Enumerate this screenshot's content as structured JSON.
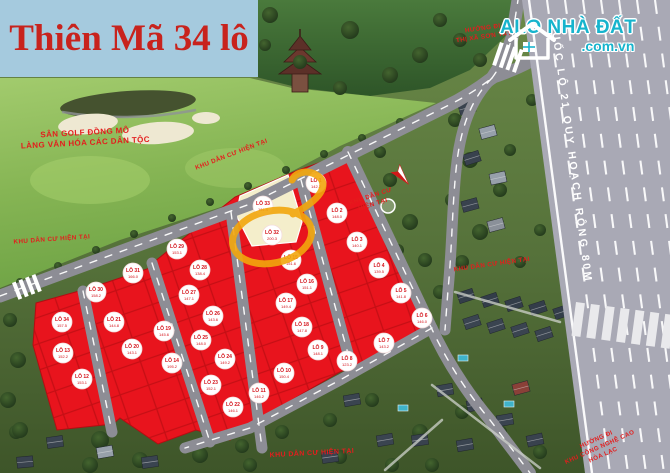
{
  "title": "Thiên Mã 34 lô",
  "logo": {
    "name": "ALO NHÀ ĐẤT",
    "domain": ".com.vn"
  },
  "colors": {
    "title_bg": "#a5cade",
    "title_text": "#c8231d",
    "plot_red": "#e8141d",
    "plot_line": "#b90d12",
    "plot_reserved_cream": "#f4eecb",
    "badge_text": "#d4121a",
    "road_gray": "#8d8d95",
    "highway_gray": "#a9a9b5",
    "highlight_orange": "#f2a70d",
    "label_red": "#e41d1d",
    "logo_teal": "#17b4cd",
    "golf_green": "#86b554"
  },
  "map": {
    "highway_label": "QUỐC LỘ 21 QUY HOẠCH RỘNG 80M",
    "labels": [
      {
        "name": "golf-label",
        "lines": [
          "SÂN GOLF ĐỒNG MÔ",
          "LÀNG VĂN HÓA CÁC DÂN TỘC"
        ],
        "x": 85,
        "y": 135,
        "rot": -3,
        "size": 8
      },
      {
        "name": "existing-residential-left",
        "lines": [
          "KHU DÂN CƯ HIỆN TẠI"
        ],
        "x": 52,
        "y": 241,
        "rot": -4,
        "size": 6.3
      },
      {
        "name": "existing-residential-top",
        "lines": [
          "KHU DÂN CƯ HIỆN TẠI"
        ],
        "x": 232,
        "y": 156,
        "rot": -21,
        "size": 6.3
      },
      {
        "name": "existing-residential-mid",
        "lines": [
          "KHU DÂN CƯ",
          "HIỆN TẠI"
        ],
        "x": 371,
        "y": 198,
        "rot": -18,
        "size": 6.3
      },
      {
        "name": "existing-residential-right",
        "lines": [
          "KHU DÂN CƯ HIỆN TẠI"
        ],
        "x": 492,
        "y": 266,
        "rot": -8,
        "size": 6.3
      },
      {
        "name": "existing-residential-bottom",
        "lines": [
          "KHU DÂN CƯ HIỆN TẠI"
        ],
        "x": 312,
        "y": 455,
        "rot": -3,
        "size": 7
      },
      {
        "name": "direction-son-tay",
        "lines": [
          "HƯỚNG ĐI",
          "THỊ XÃ SƠN TÂY"
        ],
        "x": 483,
        "y": 30,
        "rot": -8,
        "size": 6.3
      },
      {
        "name": "direction-hoa-lac",
        "lines": [
          "HƯỚNG ĐI",
          "KHU CÔNG NGHỆ CAO",
          "HÒA LẠC"
        ],
        "x": 597,
        "y": 441,
        "rot": -24,
        "size": 6.2
      }
    ]
  },
  "plots": [
    {
      "label": "LÔ 1",
      "area": "142.2",
      "x": 316,
      "y": 183
    },
    {
      "label": "LÔ 2",
      "area": "148.0",
      "x": 337,
      "y": 213
    },
    {
      "label": "LÔ 3",
      "area": "140.1",
      "x": 357,
      "y": 242
    },
    {
      "label": "LÔ 4",
      "area": "139.5",
      "x": 379,
      "y": 268
    },
    {
      "label": "LÔ 5",
      "area": "141.8",
      "x": 401,
      "y": 293
    },
    {
      "label": "LÔ 6",
      "area": "146.0",
      "x": 422,
      "y": 318
    },
    {
      "label": "LÔ 7",
      "area": "143.2",
      "x": 384,
      "y": 343
    },
    {
      "label": "LÔ 8",
      "area": "123.2",
      "x": 347,
      "y": 361
    },
    {
      "label": "LÔ 9",
      "area": "148.1",
      "x": 318,
      "y": 350
    },
    {
      "label": "LÔ 10",
      "area": "150.4",
      "x": 284,
      "y": 373
    },
    {
      "label": "LÔ 11",
      "area": "146.2",
      "x": 259,
      "y": 393
    },
    {
      "label": "LÔ 12",
      "area": "153.1",
      "x": 82,
      "y": 379
    },
    {
      "label": "LÔ 13",
      "area": "152.2",
      "x": 63,
      "y": 353
    },
    {
      "label": "LÔ 14",
      "area": "195.2",
      "x": 172,
      "y": 363
    },
    {
      "label": "LÔ 15",
      "area": "151.6",
      "x": 291,
      "y": 260
    },
    {
      "label": "LÔ 16",
      "area": "151.1",
      "x": 307,
      "y": 284
    },
    {
      "label": "LÔ 17",
      "area": "149.4",
      "x": 286,
      "y": 303
    },
    {
      "label": "LÔ 18",
      "area": "147.8",
      "x": 302,
      "y": 327
    },
    {
      "label": "LÔ 19",
      "area": "145.6",
      "x": 164,
      "y": 331
    },
    {
      "label": "LÔ 20",
      "area": "143.1",
      "x": 132,
      "y": 349
    },
    {
      "label": "LÔ 21",
      "area": "144.8",
      "x": 114,
      "y": 322
    },
    {
      "label": "LÔ 22",
      "area": "146.1",
      "x": 233,
      "y": 407
    },
    {
      "label": "LÔ 23",
      "area": "152.1",
      "x": 211,
      "y": 385
    },
    {
      "label": "LÔ 24",
      "area": "149.2",
      "x": 225,
      "y": 359
    },
    {
      "label": "LÔ 25",
      "area": "148.0",
      "x": 201,
      "y": 340
    },
    {
      "label": "LÔ 26",
      "area": "143.6",
      "x": 213,
      "y": 316
    },
    {
      "label": "LÔ 27",
      "area": "147.1",
      "x": 189,
      "y": 295
    },
    {
      "label": "LÔ 28",
      "area": "138.4",
      "x": 200,
      "y": 270
    },
    {
      "label": "LÔ 29",
      "area": "153.1",
      "x": 177,
      "y": 249
    },
    {
      "label": "LÔ 30",
      "area": "158.2",
      "x": 96,
      "y": 292
    },
    {
      "label": "LÔ 31",
      "area": "166.0",
      "x": 133,
      "y": 273
    },
    {
      "label": "LÔ 32",
      "area": "200.3",
      "x": 272,
      "y": 235,
      "state": "highlighted"
    },
    {
      "label": "LÔ 33",
      "area": "161.4",
      "x": 263,
      "y": 206,
      "state": "reserved"
    },
    {
      "label": "LÔ 34",
      "area": "157.5",
      "x": 62,
      "y": 322
    }
  ]
}
